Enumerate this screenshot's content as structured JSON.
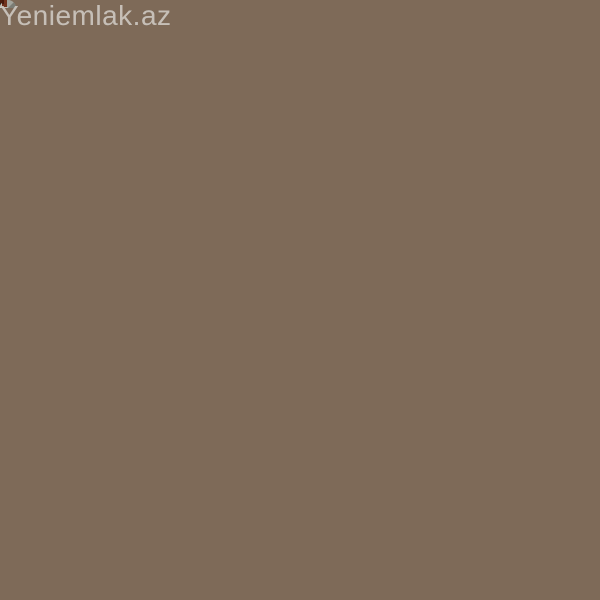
{
  "watermarks": {
    "top_left": "Yeniemlak.az",
    "center": "Yeniemlak.az",
    "bottom_right": "Yeniemlak.az"
  },
  "appliances": {
    "washing_machine_brand": "Indesit"
  },
  "colors": {
    "cabinet_wood": "#8a5227",
    "cabinet_wood_dark": "#57280f",
    "frosted_glass": "#e3cfa2",
    "granite_counter": "#a87c4a",
    "wall_tile": "#9c8773",
    "mosaic_tile": "#8f8c84",
    "range_hood": "#ece6d6",
    "washer_body": "#e2ded1",
    "base_cabinet_maroon": "#5c2513",
    "stainless_steel": "#8b887c",
    "brass_handle": "#c9a45c"
  }
}
